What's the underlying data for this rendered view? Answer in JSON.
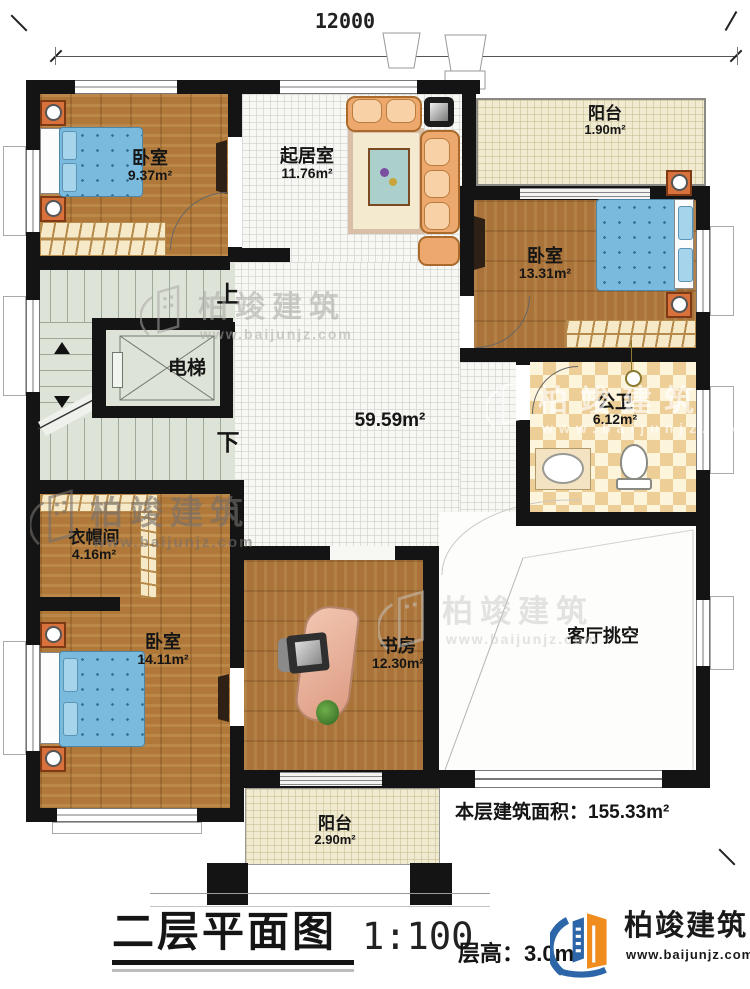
{
  "plan": {
    "dimension_top": "12000",
    "dimension_right": "14200",
    "floor_area_note": "本层建筑面积：155.33m²",
    "stairs_up": "上",
    "stairs_down": "下"
  },
  "rooms": [
    {
      "name": "卧室",
      "area": "9.37m²"
    },
    {
      "name": "起居室",
      "area": "11.76m²"
    },
    {
      "name": "阳台",
      "area": "1.90m²"
    },
    {
      "name": "卧室",
      "area": "13.31m²"
    },
    {
      "name": "公卫",
      "area": "6.12m²"
    },
    {
      "name": "电梯",
      "area": ""
    },
    {
      "name": "",
      "area": "59.59m²"
    },
    {
      "name": "衣帽间",
      "area": "4.16m²"
    },
    {
      "name": "卧室",
      "area": "14.11m²"
    },
    {
      "name": "书房",
      "area": "12.30m²"
    },
    {
      "name": "客厅挑空",
      "area": ""
    },
    {
      "name": "阳台",
      "area": "2.90m²"
    }
  ],
  "title_block": {
    "title": "二层平面图",
    "scale": "1:100",
    "floor_height": "层高：3.0m"
  },
  "brand": {
    "name": "柏竣建筑",
    "website": "www.baijunjz.com"
  }
}
